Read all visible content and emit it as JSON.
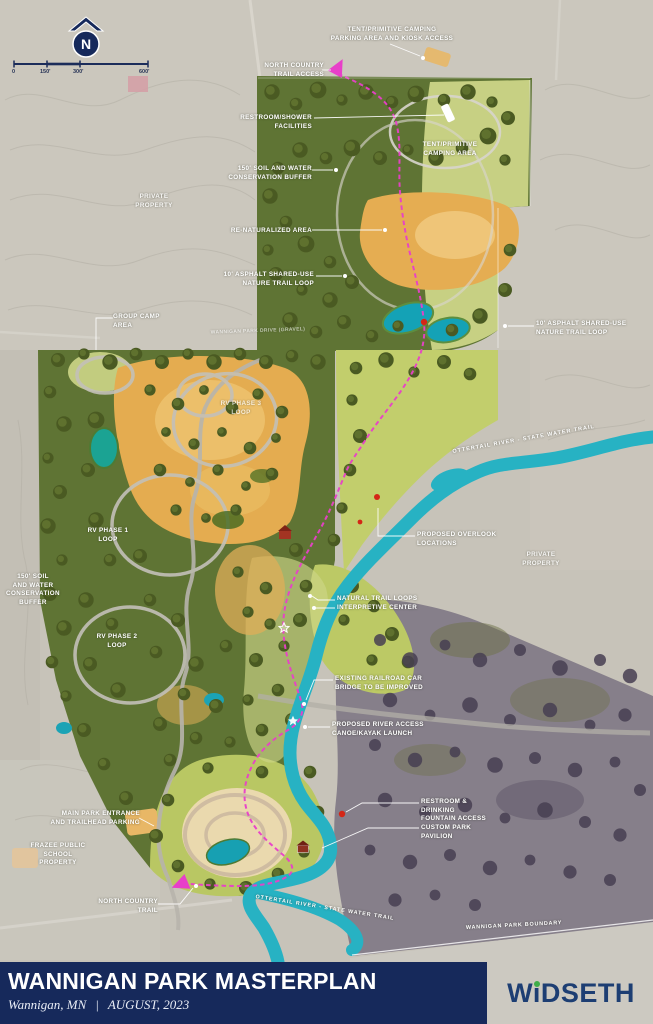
{
  "page": {
    "width": 653,
    "height": 1024
  },
  "compass": {
    "letter": "N"
  },
  "scale_bar": {
    "ticks": [
      "0",
      "150'",
      "300'",
      "600'"
    ]
  },
  "map_labels": {
    "tent_parking": "TENT/PRIMITIVE CAMPING\nPARKING AREA AND KIOSK ACCESS",
    "nct_access": "NORTH COUNTRY\nTRAIL ACCESS",
    "restroom_shower": "RESTROOM/SHOWER\nFACILITIES",
    "tent_camping": "TENT/PRIMITIVE\nCAMPING AREA",
    "buffer_n": "150' SOIL AND WATER\nCONSERVATION BUFFER",
    "private_nw": "PRIVATE\nPROPERTY",
    "renaturalized": "RE-NATURALIZED AREA",
    "asphalt_w": "10' ASPHALT SHARED-USE\nNATURE TRAIL LOOP",
    "group_camp": "GROUP CAMP\nAREA",
    "park_drive": "WANNIGAN PARK DRIVE (GRAVEL)",
    "asphalt_e": "10' ASPHALT SHARED-USE\nNATURE TRAIL LOOP",
    "rv3": "RV PHASE 3\nLOOP",
    "rv1": "RV PHASE 1\nLOOP",
    "buffer_w": "150' SOIL\nAND WATER\nCONSERVATION\nBUFFER",
    "rv2": "RV PHASE 2\nLOOP",
    "river_mid": "OTTERTAIL RIVER - STATE WATER TRAIL",
    "overlook": "PROPOSED OVERLOOK\nLOCATIONS",
    "private_e": "PRIVATE\nPROPERTY",
    "natural_trail": "NATURAL TRAIL LOOPS\nINTERPRETIVE CENTER",
    "railroad": "EXISTING RAILROAD CAR\nBRIDGE TO BE IMPROVED",
    "canoe": "PROPOSED RIVER ACCESS\nCANOE/KAYAK LAUNCH",
    "restroom_fountain": "RESTROOM & DRINKING\nFOUNTAIN ACCESS",
    "pavilion": "CUSTOM PARK\nPAVILION",
    "entrance": "MAIN PARK ENTRANCE\nAND TRAILHEAD PARKING",
    "school": "FRAZEE PUBLIC\nSCHOOL\nPROPERTY",
    "nct_s": "NORTH COUNTRY\nTRAIL",
    "river_s": "OTTERTAIL RIVER - STATE WATER TRAIL",
    "boundary": "WANNIGAN PARK BOUNDARY"
  },
  "title_block": {
    "title": "WANNIGAN PARK MASTERPLAN",
    "location": "Wannigan, MN",
    "separator": "|",
    "date": "AUGUST, 2023"
  },
  "brand": {
    "name": "WiDSETH"
  },
  "colors": {
    "navy": "#16295b",
    "river_teal": "#27b2c3",
    "trail_magenta": "#e83fc9",
    "forest_green": "#5d7030",
    "meadow_orange": "#e4ac50",
    "brand_navy": "#1d3e73",
    "brand_green": "#3fae49"
  }
}
